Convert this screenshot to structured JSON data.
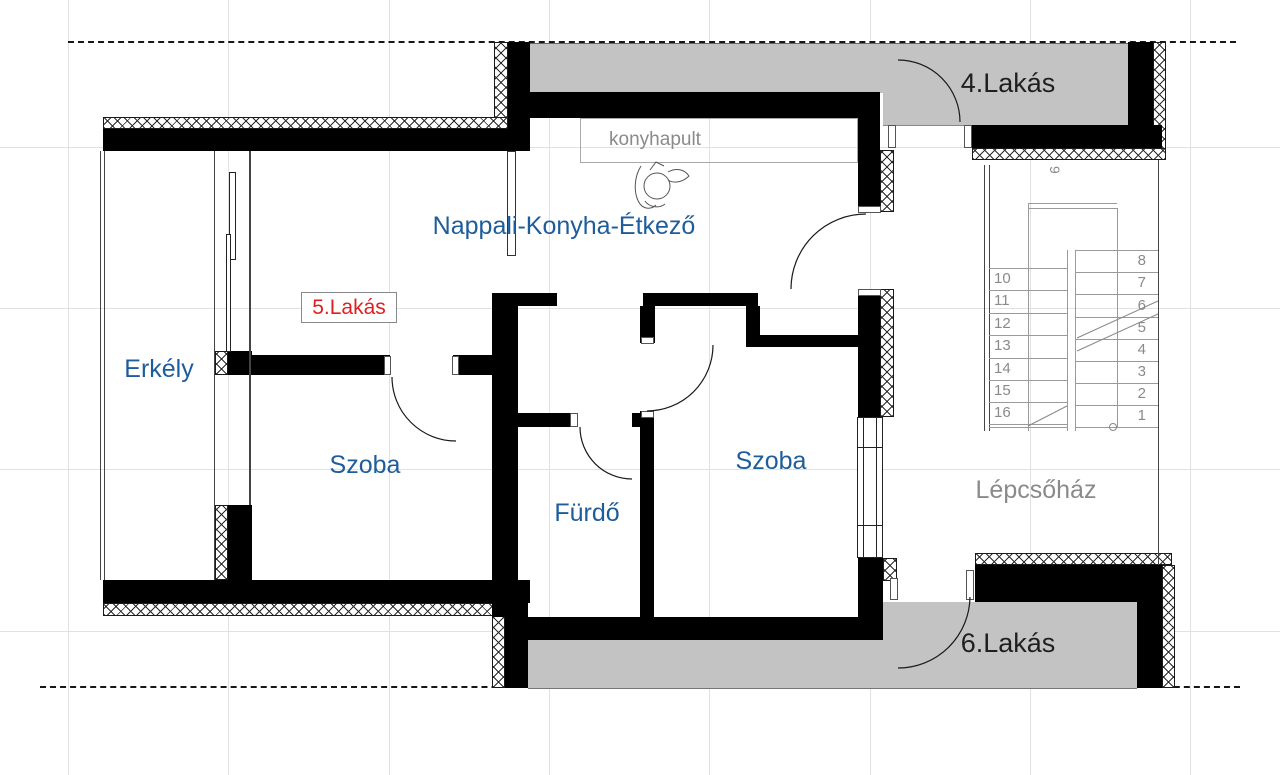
{
  "drawing": {
    "type": "architectural floor plan",
    "colors": {
      "room_label_blue": "#1e5d9b",
      "highlight_red": "#df1f1f",
      "muted_gray": "#8a8a8a",
      "dark_text": "#1f1f1f",
      "neighbor_floor_gray": "#c3c3c3",
      "wall_black": "#000000"
    }
  },
  "labels": {
    "apartment4": "4.Lakás",
    "apartment5": "5.Lakás",
    "apartment6": "6.Lakás",
    "living_kitchen_dining": "Nappali-Konyha-Étkező",
    "kitchen_counter": "konyhapult",
    "balcony": "Erkély",
    "room_left": "Szoba",
    "room_right": "Szoba",
    "bathroom": "Fürdő",
    "stairwell": "Lépcsőház"
  },
  "stairs": {
    "left_flight": [
      "10",
      "11",
      "12",
      "13",
      "14",
      "15",
      "16"
    ],
    "right_flight": [
      "8",
      "7",
      "6",
      "5",
      "4",
      "3",
      "2",
      "1"
    ],
    "landing_step": "9"
  }
}
